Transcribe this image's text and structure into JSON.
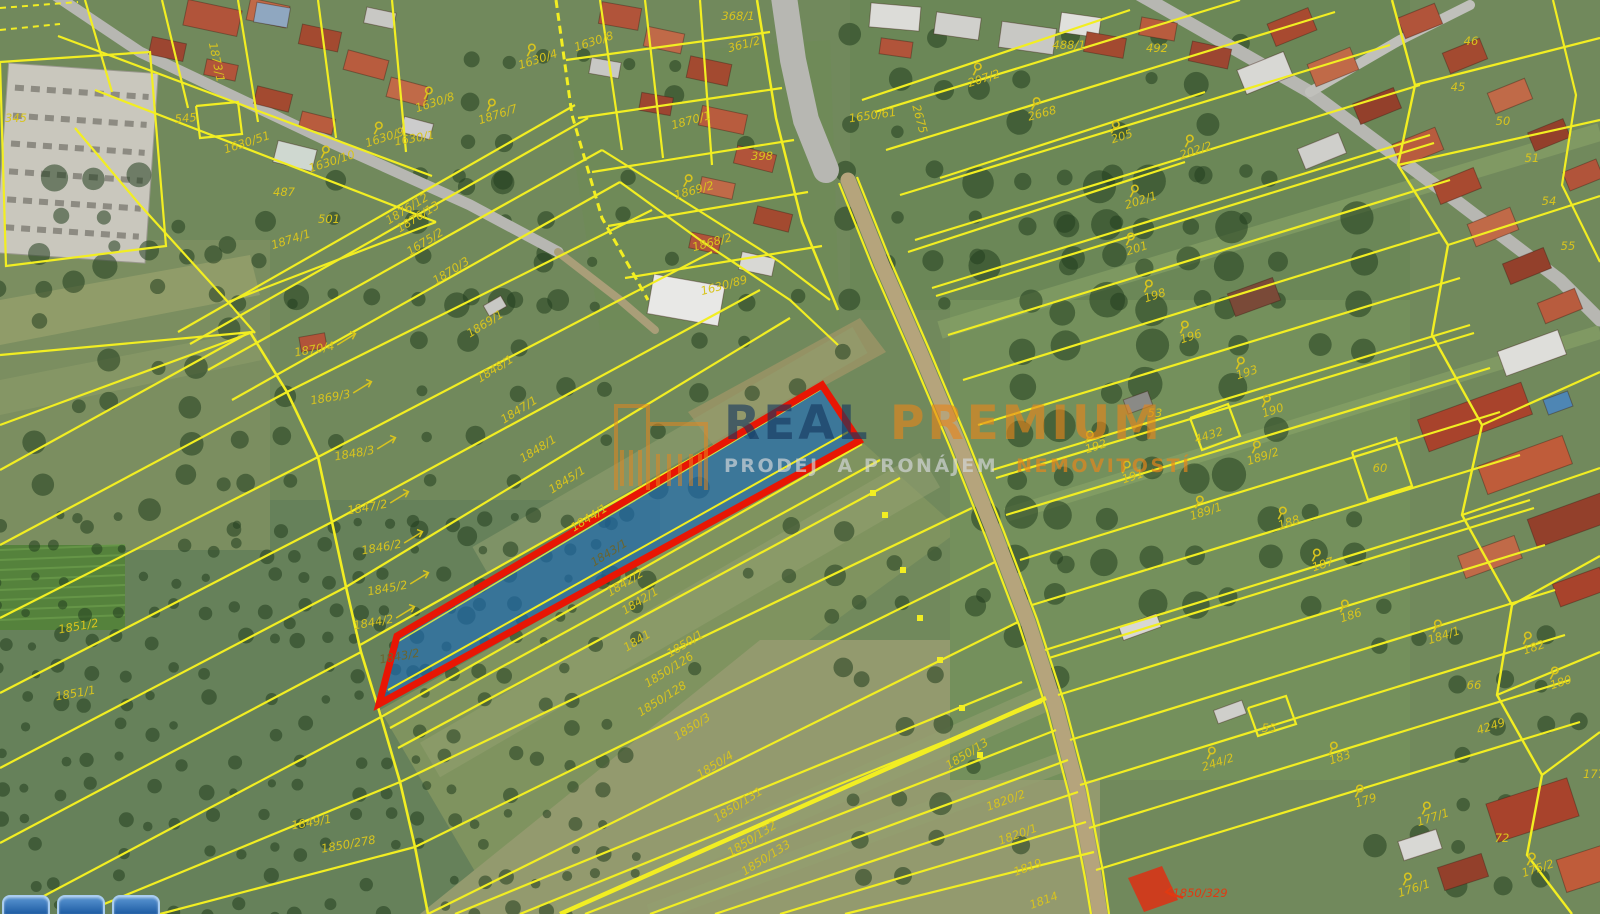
{
  "watermark": {
    "brand_real": "REAL",
    "brand_premium": "PREMIUM",
    "tagline_1": "PRODEJ",
    "tagline_2": "A PRONÁJEM",
    "tagline_3": "NEMOVITOSTÍ",
    "icon": "building-outline-icon"
  },
  "colors": {
    "boundary": "#f2ee22",
    "label": "#d8c41e",
    "label_dark": "#6a6530",
    "label_red": "#e03a12",
    "highlight_outline": "#e81604",
    "highlight_fill": "rgba(28,108,190,0.62)"
  },
  "highlight": {
    "label": "1843/1",
    "tip_label": "1843/2",
    "red_building_label": "1850/329"
  },
  "parcel_labels": [
    {
      "t": "1630/1",
      "x": 415,
      "y": 142,
      "r": -10
    },
    {
      "t": "345",
      "x": 16,
      "y": 122,
      "r": 0
    },
    {
      "t": "545",
      "x": 186,
      "y": 122,
      "r": -5
    },
    {
      "t": "1630/51",
      "x": 248,
      "y": 146,
      "r": -18
    },
    {
      "t": "1630/10",
      "x": 333,
      "y": 165,
      "r": -18,
      "s": 1
    },
    {
      "t": "487",
      "x": 284,
      "y": 196,
      "r": 0
    },
    {
      "t": "501",
      "x": 329,
      "y": 223,
      "r": 0
    },
    {
      "t": "1874/1",
      "x": 292,
      "y": 243,
      "r": -18
    },
    {
      "t": "1630/8",
      "x": 436,
      "y": 106,
      "r": -18,
      "s": 1
    },
    {
      "t": "1630/9",
      "x": 386,
      "y": 141,
      "r": -18,
      "s": 1
    },
    {
      "t": "1630/4",
      "x": 539,
      "y": 63,
      "r": -18,
      "s": 1
    },
    {
      "t": "1630/8",
      "x": 595,
      "y": 45,
      "r": -18
    },
    {
      "t": "1876/7",
      "x": 499,
      "y": 118,
      "r": -18,
      "s": 1
    },
    {
      "t": "368/1",
      "x": 738,
      "y": 20,
      "r": 0
    },
    {
      "t": "361/2",
      "x": 745,
      "y": 48,
      "r": -15
    },
    {
      "t": "1870/1",
      "x": 692,
      "y": 124,
      "r": -15
    },
    {
      "t": "398",
      "x": 762,
      "y": 160,
      "r": 0
    },
    {
      "t": "1869/2",
      "x": 695,
      "y": 194,
      "r": -15,
      "s": 1
    },
    {
      "t": "1868/2",
      "x": 713,
      "y": 246,
      "r": -15
    },
    {
      "t": "1630/89",
      "x": 725,
      "y": 289,
      "r": -15
    },
    {
      "t": "1873/1",
      "x": 213,
      "y": 63,
      "r": 78
    },
    {
      "t": "1876/12",
      "x": 409,
      "y": 212,
      "r": -32
    },
    {
      "t": "1876/13",
      "x": 420,
      "y": 220,
      "r": -32
    },
    {
      "t": "1675/2",
      "x": 427,
      "y": 245,
      "r": -32
    },
    {
      "t": "1870/3",
      "x": 453,
      "y": 274,
      "r": -32
    },
    {
      "t": "1869/1",
      "x": 487,
      "y": 327,
      "r": -32
    },
    {
      "t": "1870/4",
      "x": 315,
      "y": 353,
      "r": -10,
      "a": "r"
    },
    {
      "t": "1848/1",
      "x": 497,
      "y": 372,
      "r": -32
    },
    {
      "t": "1869/3",
      "x": 331,
      "y": 401,
      "r": -10,
      "a": "r"
    },
    {
      "t": "1847/1",
      "x": 521,
      "y": 413,
      "r": -32
    },
    {
      "t": "1848/3",
      "x": 355,
      "y": 457,
      "r": -10,
      "a": "r"
    },
    {
      "t": "1848/1",
      "x": 540,
      "y": 452,
      "r": -32
    },
    {
      "t": "1845/1",
      "x": 569,
      "y": 483,
      "r": -32
    },
    {
      "t": "1847/2",
      "x": 368,
      "y": 511,
      "r": -10,
      "a": "r"
    },
    {
      "t": "1846/2",
      "x": 382,
      "y": 551,
      "r": -10,
      "a": "r"
    },
    {
      "t": "1845/2",
      "x": 388,
      "y": 592,
      "r": -10,
      "a": "r"
    },
    {
      "t": "1844/2",
      "x": 374,
      "y": 626,
      "r": -10,
      "a": "r"
    },
    {
      "t": "1844/1",
      "x": 591,
      "y": 521,
      "r": -32
    },
    {
      "t": "1843/1",
      "x": 611,
      "y": 556,
      "r": -32,
      "c": "dark"
    },
    {
      "t": "1843/2",
      "x": 400,
      "y": 660,
      "r": -10,
      "c": "dark"
    },
    {
      "t": "1842/2",
      "x": 627,
      "y": 586,
      "r": -32
    },
    {
      "t": "1842/1",
      "x": 642,
      "y": 604,
      "r": -32
    },
    {
      "t": "1841",
      "x": 639,
      "y": 644,
      "r": -32
    },
    {
      "t": "1850/1",
      "x": 687,
      "y": 647,
      "r": -32
    },
    {
      "t": "1850/126",
      "x": 671,
      "y": 673,
      "r": -32
    },
    {
      "t": "1850/128",
      "x": 664,
      "y": 702,
      "r": -32
    },
    {
      "t": "1850/3",
      "x": 694,
      "y": 730,
      "r": -32
    },
    {
      "t": "1850/4",
      "x": 717,
      "y": 768,
      "r": -32
    },
    {
      "t": "1850/131",
      "x": 740,
      "y": 808,
      "r": -32
    },
    {
      "t": "1850/132",
      "x": 754,
      "y": 842,
      "r": -32
    },
    {
      "t": "1850/133",
      "x": 768,
      "y": 861,
      "r": -32
    },
    {
      "t": "1850/13",
      "x": 969,
      "y": 757,
      "r": -32
    },
    {
      "t": "1849/1",
      "x": 312,
      "y": 826,
      "r": -10
    },
    {
      "t": "1850/278",
      "x": 349,
      "y": 848,
      "r": -10
    },
    {
      "t": "1851/2",
      "x": 79,
      "y": 630,
      "r": -10
    },
    {
      "t": "1851/1",
      "x": 76,
      "y": 697,
      "r": -10
    },
    {
      "t": "1820/2",
      "x": 1007,
      "y": 804,
      "r": -20
    },
    {
      "t": "1820/1",
      "x": 1019,
      "y": 838,
      "r": -20
    },
    {
      "t": "1819",
      "x": 1029,
      "y": 871,
      "r": -20
    },
    {
      "t": "1814",
      "x": 1045,
      "y": 904,
      "r": -20
    },
    {
      "t": "1850/329",
      "x": 1200,
      "y": 897,
      "r": 0,
      "c": "red",
      "a": "l"
    },
    {
      "t": "207/2",
      "x": 985,
      "y": 82,
      "r": -18,
      "s": 1
    },
    {
      "t": "488/1",
      "x": 1069,
      "y": 49,
      "r": 0
    },
    {
      "t": "492",
      "x": 1157,
      "y": 52,
      "r": 0
    },
    {
      "t": "1650/61",
      "x": 873,
      "y": 119,
      "r": -8
    },
    {
      "t": "2675",
      "x": 916,
      "y": 120,
      "r": 75
    },
    {
      "t": "2668",
      "x": 1043,
      "y": 117,
      "r": -15,
      "s": 1
    },
    {
      "t": "205",
      "x": 1123,
      "y": 140,
      "r": -18,
      "s": 1
    },
    {
      "t": "202/2",
      "x": 1197,
      "y": 154,
      "r": -18,
      "s": 1
    },
    {
      "t": "202/1",
      "x": 1142,
      "y": 204,
      "r": -18,
      "s": 1
    },
    {
      "t": "201",
      "x": 1138,
      "y": 252,
      "r": -18,
      "s": 1
    },
    {
      "t": "198",
      "x": 1156,
      "y": 299,
      "r": -18,
      "s": 1
    },
    {
      "t": "196",
      "x": 1192,
      "y": 340,
      "r": -18,
      "s": 1
    },
    {
      "t": "193",
      "x": 1248,
      "y": 376,
      "r": -18,
      "s": 1
    },
    {
      "t": "190",
      "x": 1274,
      "y": 414,
      "r": -18,
      "s": 1
    },
    {
      "t": "53",
      "x": 1155,
      "y": 417,
      "r": 0
    },
    {
      "t": "4432",
      "x": 1210,
      "y": 439,
      "r": -18
    },
    {
      "t": "192",
      "x": 1097,
      "y": 450,
      "r": -18,
      "s": 1
    },
    {
      "t": "189/2",
      "x": 1264,
      "y": 460,
      "r": -18,
      "s": 1
    },
    {
      "t": "60",
      "x": 1380,
      "y": 472,
      "r": 0
    },
    {
      "t": "191",
      "x": 1134,
      "y": 480,
      "r": -18,
      "s": 1
    },
    {
      "t": "189/1",
      "x": 1207,
      "y": 515,
      "r": -18,
      "s": 1
    },
    {
      "t": "188",
      "x": 1290,
      "y": 526,
      "r": -18,
      "s": 1
    },
    {
      "t": "187",
      "x": 1324,
      "y": 568,
      "r": -18,
      "s": 1
    },
    {
      "t": "186",
      "x": 1352,
      "y": 619,
      "r": -18,
      "s": 1
    },
    {
      "t": "184/1",
      "x": 1445,
      "y": 639,
      "r": -18,
      "s": 1
    },
    {
      "t": "182",
      "x": 1535,
      "y": 651,
      "r": -18,
      "s": 1
    },
    {
      "t": "180",
      "x": 1562,
      "y": 686,
      "r": -18,
      "s": 1
    },
    {
      "t": "66",
      "x": 1474,
      "y": 689,
      "r": 0
    },
    {
      "t": "4249",
      "x": 1492,
      "y": 730,
      "r": -18
    },
    {
      "t": "55",
      "x": 1269,
      "y": 732,
      "r": 0
    },
    {
      "t": "244/2",
      "x": 1219,
      "y": 766,
      "r": -18,
      "s": 1
    },
    {
      "t": "183",
      "x": 1341,
      "y": 761,
      "r": -18,
      "s": 1
    },
    {
      "t": "179",
      "x": 1367,
      "y": 804,
      "r": -18,
      "s": 1
    },
    {
      "t": "177/1",
      "x": 1434,
      "y": 821,
      "r": -18,
      "s": 1
    },
    {
      "t": "72",
      "x": 1502,
      "y": 842,
      "r": 0
    },
    {
      "t": "175/2",
      "x": 1539,
      "y": 872,
      "r": -18,
      "s": 1
    },
    {
      "t": "176/1",
      "x": 1415,
      "y": 892,
      "r": -18,
      "s": 1
    },
    {
      "t": "177",
      "x": 1594,
      "y": 778,
      "r": 0
    },
    {
      "t": "46",
      "x": 1471,
      "y": 45,
      "r": 0
    },
    {
      "t": "45",
      "x": 1458,
      "y": 91,
      "r": 0
    },
    {
      "t": "50",
      "x": 1503,
      "y": 125,
      "r": 0
    },
    {
      "t": "51",
      "x": 1532,
      "y": 162,
      "r": 0
    },
    {
      "t": "54",
      "x": 1549,
      "y": 205,
      "r": 0
    },
    {
      "t": "55",
      "x": 1568,
      "y": 250,
      "r": 0
    }
  ]
}
